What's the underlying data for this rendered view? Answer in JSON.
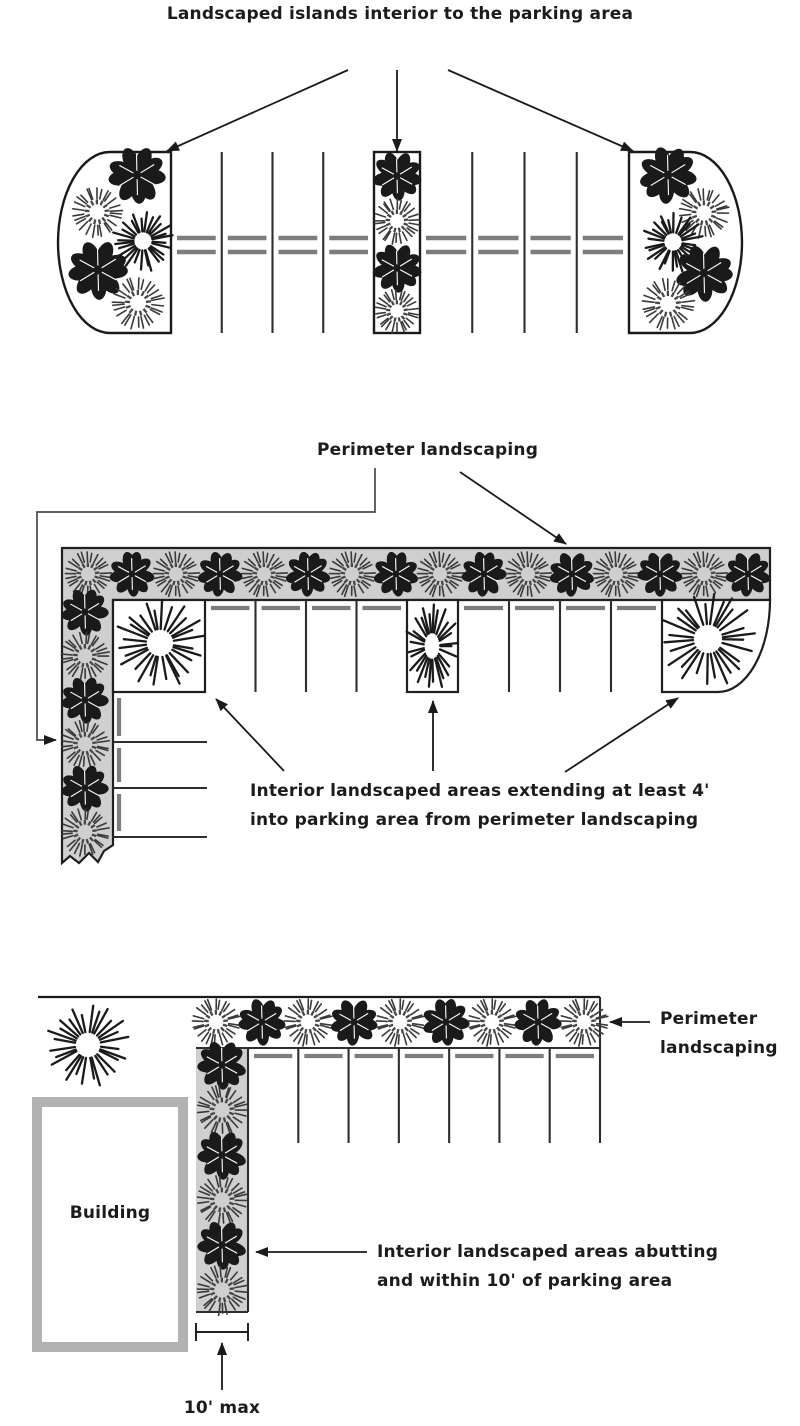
{
  "canvas": {
    "width": 800,
    "height": 1426,
    "background": "#ffffff"
  },
  "colors": {
    "ink": "#1a1a1a",
    "line": "#2e2e2e",
    "gray_strip": "#cfcfcf",
    "dash": "#7d7d7d",
    "leader": "#4a4a4a",
    "building_border": "#b2b2b2",
    "light_shrub": "#3a3a3a",
    "light_shrub_inner": "#474747"
  },
  "figure1": {
    "label": "Landscaped islands interior to the parking area",
    "geometry": {
      "arrows": [
        [
          348,
          70,
          167,
          151
        ],
        [
          397,
          70,
          397,
          151
        ],
        [
          448,
          70,
          633,
          151
        ]
      ],
      "islands": [
        {
          "path": "M110,152 A52,91 0 0 0 58,242.5 A52,91 0 0 0 110,333 L171,333 L171,152 Z"
        },
        {
          "rect": [
            374,
            152,
            46,
            181
          ]
        },
        {
          "path": "M690,152 A52,91 0 0 1 742,242.5 A52,91 0 0 1 690,333 L629,333 L629,152 Z"
        }
      ],
      "stall_top": 152,
      "stall_bottom": 333,
      "bays": [
        {
          "from": 171,
          "to": 374,
          "stalls": 4
        },
        {
          "from": 420,
          "to": 629,
          "stalls": 4
        }
      ],
      "dash_rows": [
        238,
        252
      ],
      "plants": [
        {
          "t": "dark",
          "x": 137,
          "y": 175,
          "r": 28
        },
        {
          "t": "light",
          "x": 97,
          "y": 212,
          "r": 24
        },
        {
          "t": "tree",
          "x": 143,
          "y": 241,
          "r": 30
        },
        {
          "t": "dark",
          "x": 98,
          "y": 270,
          "r": 29
        },
        {
          "t": "light",
          "x": 138,
          "y": 303,
          "r": 25
        },
        {
          "t": "dark",
          "x": 397,
          "y": 176,
          "r": 24
        },
        {
          "t": "light",
          "x": 397,
          "y": 221,
          "r": 22
        },
        {
          "t": "dark",
          "x": 397,
          "y": 268,
          "r": 24
        },
        {
          "t": "light",
          "x": 397,
          "y": 311,
          "r": 21
        },
        {
          "t": "dark",
          "x": 668,
          "y": 175,
          "r": 28
        },
        {
          "t": "light",
          "x": 704,
          "y": 213,
          "r": 24
        },
        {
          "t": "tree",
          "x": 673,
          "y": 242,
          "r": 30
        },
        {
          "t": "dark",
          "x": 704,
          "y": 273,
          "r": 28
        },
        {
          "t": "light",
          "x": 668,
          "y": 304,
          "r": 25
        }
      ]
    }
  },
  "figure2": {
    "perimeter_label": "Perimeter landscaping",
    "interior_label": "Interior landscaped areas extending at least 4'\ninto parking area from perimeter landscaping",
    "geometry": {
      "l_strip_points": "62,548 770,548 770,600 113,600 113,845 104,851 98,862 89,853 79,863 70,856 62,863",
      "corner_path": "M770,600 A52,92 0 0 1 718,692 L662,692 L662,600 Z",
      "boxes": [
        [
          113,
          600,
          92,
          92
        ],
        [
          407,
          600,
          51,
          92
        ]
      ],
      "stall_top": 600,
      "stall_bottom": 692,
      "bays": [
        {
          "from": 205,
          "to": 407,
          "stalls": 4
        },
        {
          "from": 458,
          "to": 662,
          "stalls": 4
        }
      ],
      "dash_rows": [
        608
      ],
      "left_stalls": {
        "x1": 113,
        "x2": 207,
        "ys": [
          742,
          788,
          837
        ],
        "dash_x": 119,
        "dash_segs": [
          [
            698,
            736
          ],
          [
            748,
            782
          ],
          [
            794,
            831
          ]
        ]
      },
      "leader": "375,468 375,512 37,512 37,740 56,740",
      "strip_arrow": [
        460,
        472,
        566,
        544
      ],
      "pointer_arrows": [
        [
          284,
          771,
          216,
          699
        ],
        [
          433,
          771,
          433,
          701
        ],
        [
          565,
          772,
          678,
          698
        ]
      ],
      "top_row": {
        "x0": 88,
        "step": 44,
        "count": 16,
        "y": 574,
        "r": 22,
        "start": "light"
      },
      "left_col": {
        "x": 85,
        "ys": [
          612,
          656,
          700,
          744,
          788,
          832
        ],
        "r": 23,
        "start": "dark"
      },
      "trees": [
        {
          "x": 160,
          "y": 643,
          "rx": 44,
          "ry": 44
        },
        {
          "x": 432,
          "y": 646,
          "rx": 26,
          "ry": 43
        },
        {
          "x": 708,
          "y": 639,
          "rx": 47,
          "ry": 47
        }
      ]
    }
  },
  "figure3": {
    "perimeter_label": "Perimeter\nlandscaping",
    "interior_label": "Interior landscaped areas abutting\nand within 10' of parking area",
    "building_label": "Building",
    "dimension_label": "10' max",
    "geometry": {
      "top_line": [
        38,
        997,
        600,
        997
      ],
      "right_line": [
        600,
        997,
        600,
        1143
      ],
      "stall_top_line": [
        248,
        1048,
        600,
        1048
      ],
      "bays": [
        {
          "from": 248,
          "to": 600,
          "stalls": 7
        }
      ],
      "stall_top": 1048,
      "stall_bottom": 1143,
      "dash_rows": [
        1056
      ],
      "strip": {
        "x": 196,
        "y": 1048,
        "w": 52,
        "h": 264
      },
      "building": {
        "x": 32,
        "y": 1097,
        "w": 156,
        "h": 255,
        "border": 10
      },
      "dimension": {
        "line": [
          196,
          1332,
          248,
          1332
        ],
        "tick_h": 18,
        "arrow": [
          222,
          1390,
          222,
          1343
        ]
      },
      "perimeter_arrow": [
        650,
        1022,
        610,
        1022
      ],
      "interior_arrow": [
        367,
        1252,
        256,
        1252
      ],
      "shrub_row": {
        "x0": 216,
        "step": 46,
        "count": 9,
        "y": 1022,
        "r": 23,
        "start": "light"
      },
      "strip_col": {
        "x": 222,
        "ys": [
          1065,
          1110,
          1155,
          1200,
          1245,
          1290
        ],
        "r": 24,
        "start": "dark"
      },
      "big_tree": {
        "x": 88,
        "y": 1045,
        "rx": 41,
        "ry": 41
      }
    }
  }
}
